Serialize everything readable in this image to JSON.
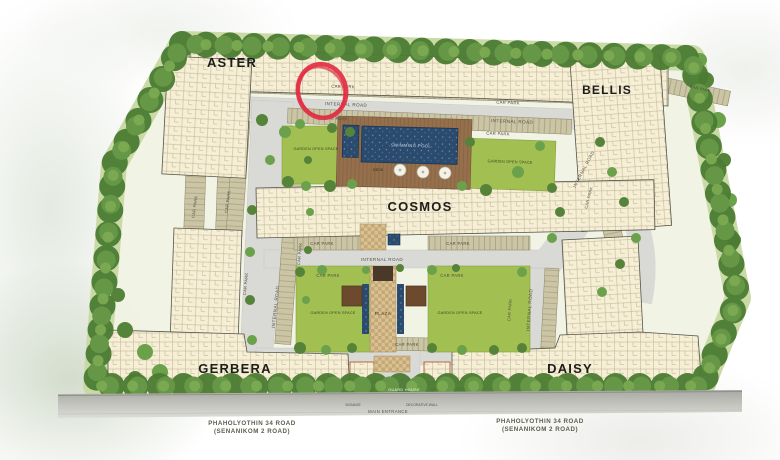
{
  "buildings": [
    {
      "name": "ASTER"
    },
    {
      "name": "BELLIS"
    },
    {
      "name": "COSMOS"
    },
    {
      "name": "GERBERA"
    },
    {
      "name": "DAISY"
    }
  ],
  "labels": {
    "car_park": "CAR PARK",
    "internal_road": "INTERNAL ROAD",
    "garden_open_space": "GARDEN OPEN SPACE",
    "plaza": "PLAZA",
    "deck": "DECK",
    "swimming_pool": "SWIMMING POOL",
    "guard_house": "GUARD HOUSE",
    "signage": "SIGNAGE",
    "main_entrance": "MAIN ENTRANCE",
    "decorative_wall": "DECORATIVE WALL"
  },
  "public_road": {
    "line1": "PHAHOLYOTHIN 34  ROAD",
    "line2": "(SENANIKOM 2  ROAD)"
  },
  "annotation": {
    "type": "hand-drawn-circle",
    "color": "#e12f44"
  },
  "colors": {
    "building": "#f6efd5",
    "internal_road": "#d9d9d5",
    "car_park": "#cbc5a5",
    "garden": "#a2bf52",
    "pool_water": "#2a4a6e",
    "tree": "#4c7c33",
    "deck": "#96704c"
  }
}
